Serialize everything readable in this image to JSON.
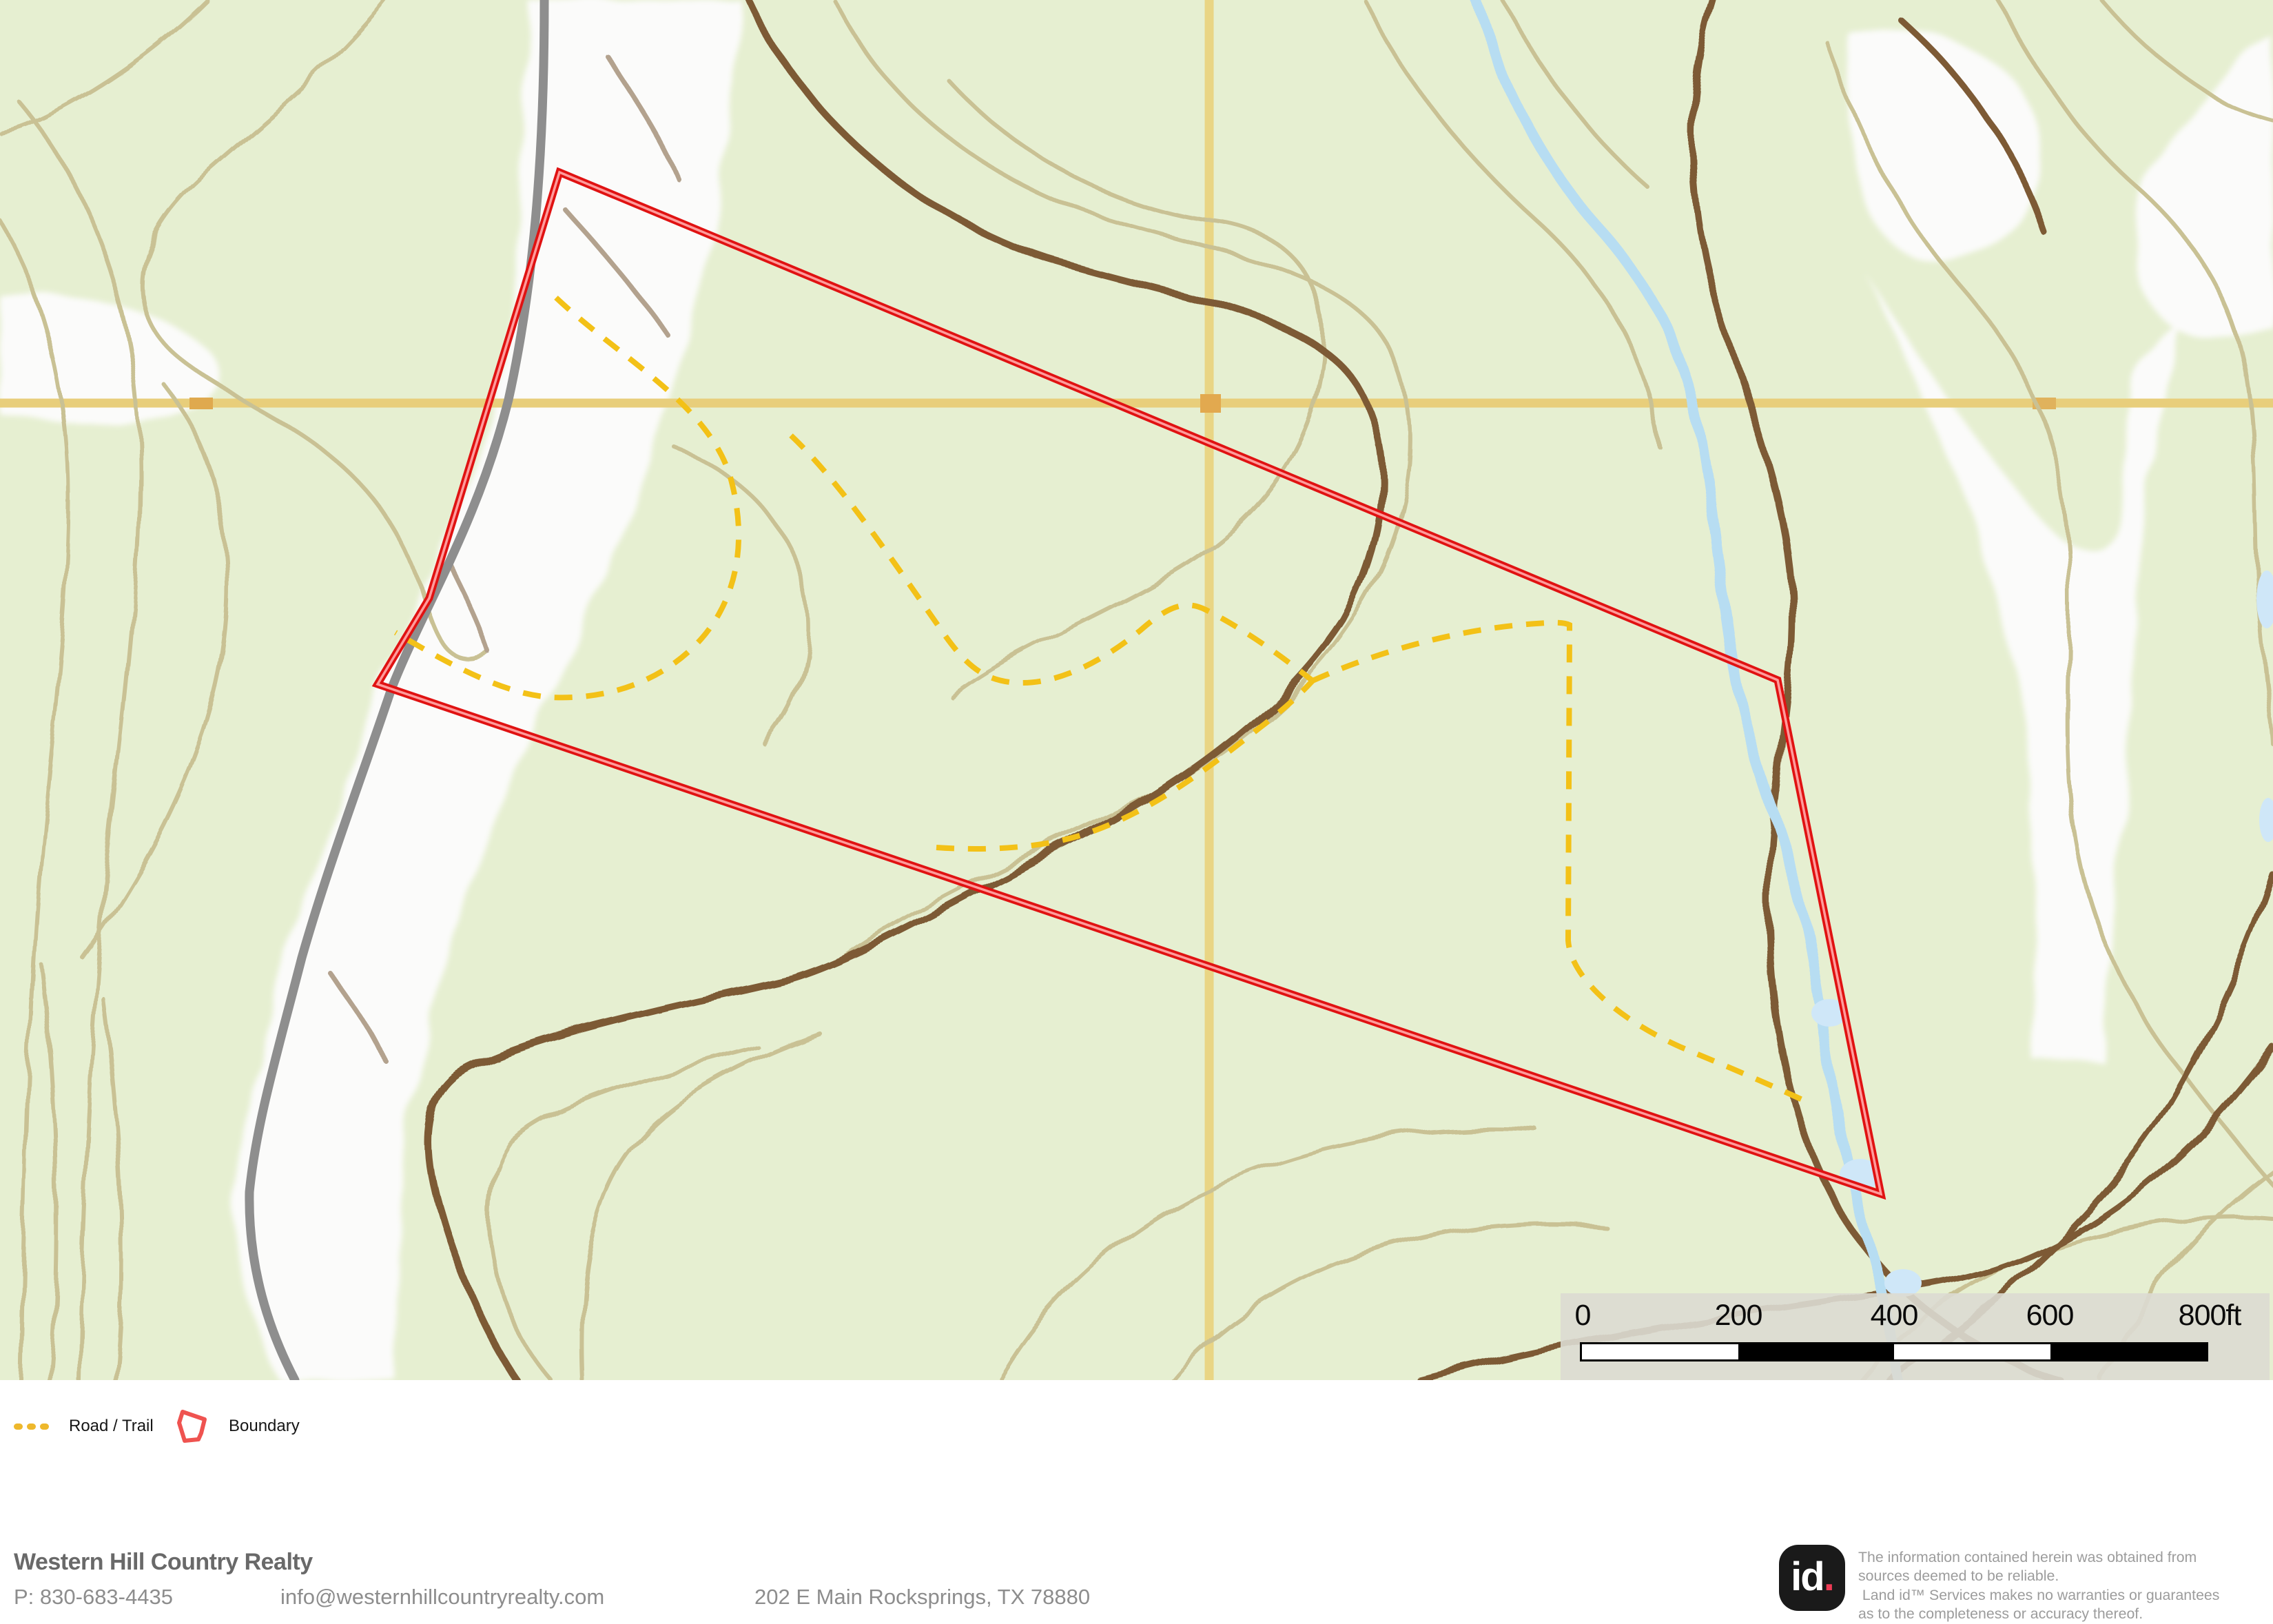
{
  "map": {
    "legend": {
      "items": [
        {
          "label": "Road / Trail",
          "icon": "dashed-line-icon",
          "color": "#eeb82c"
        },
        {
          "label": "Boundary",
          "icon": "polygon-outline-icon",
          "color": "#ef5350"
        }
      ]
    },
    "scale_bar": {
      "labels": [
        "0",
        "200",
        "400",
        "600",
        "800ft"
      ]
    },
    "colors": {
      "terrain_green": "#e6efd1",
      "contour_tan": "#c9c194",
      "contour_brown": "#7d5a36",
      "road_gray": "#8e8e8e",
      "stream_blue": "#b7ddf2",
      "grid_tan": "#e8ce7b",
      "boundary_red": "#e01212",
      "trail_yellow": "#f3c117"
    }
  },
  "footer": {
    "company": "Western Hill Country Realty",
    "phone": "P: 830-683-4435",
    "email": "info@westernhillcountryrealty.com",
    "address": "202 E Main Rocksprings, TX 78880"
  },
  "attribution": {
    "logo_text": "id",
    "logo_dot": ".",
    "disclaimer": {
      "line1": "The information contained herein was obtained from",
      "line2": "sources deemed to be reliable.",
      "line3": " Land id™ Services makes no warranties or guarantees",
      "line4": "as to the completeness or accuracy thereof."
    }
  }
}
